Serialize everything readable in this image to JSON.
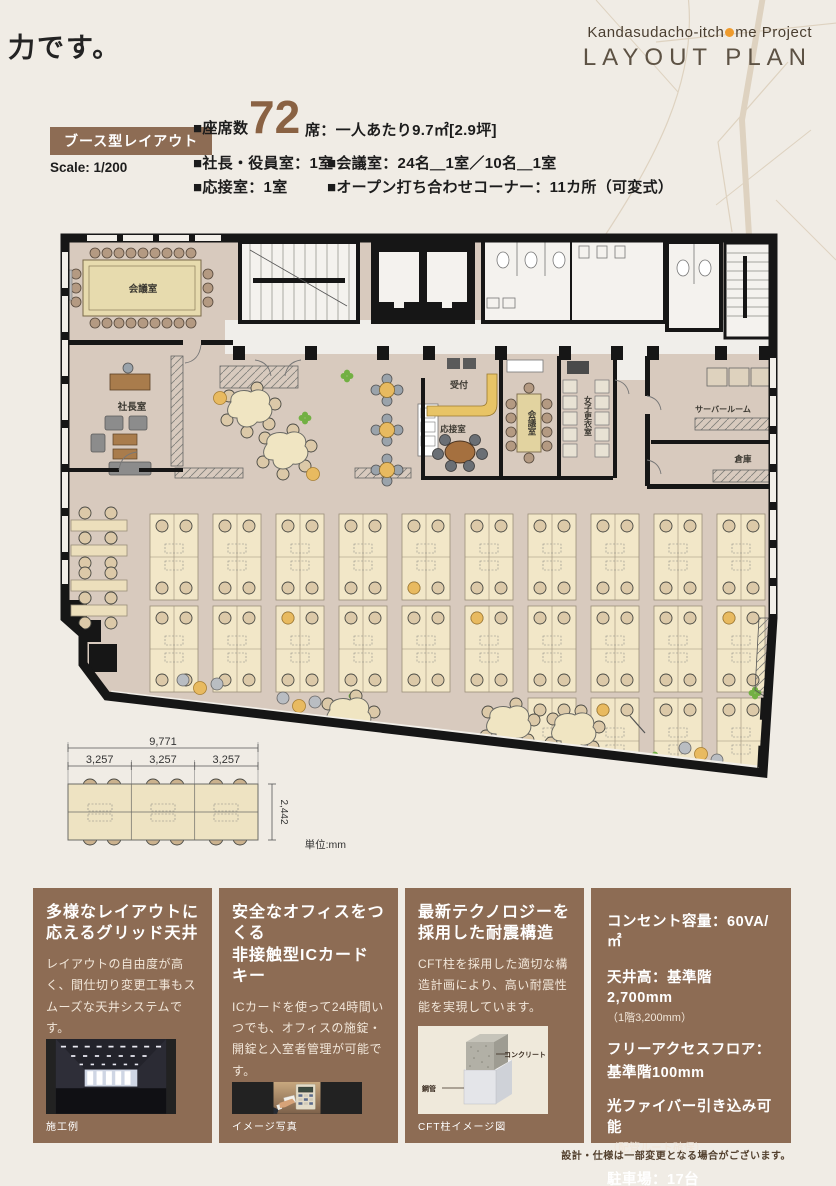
{
  "header": {
    "fragment": "力です。",
    "project_pre": "Kandasudacho-itch",
    "project_post": "me Project",
    "title": "LAYOUT PLAN"
  },
  "plan_info": {
    "type_label": "ブース型レイアウト",
    "scale": "Scale: 1/200",
    "seats": {
      "label": "■座席数",
      "value": "72",
      "detail": "席：一人あたり9.7㎡[2.9坪]"
    },
    "rooms": [
      {
        "label": "■社長・役員室：1室"
      },
      {
        "label": "■会議室：24名＿1室／10名＿1室"
      },
      {
        "label": "■応接室：1室"
      },
      {
        "label": "■オープン打ち合わせコーナー：11カ所（可変式）"
      }
    ]
  },
  "floor_plan": {
    "rooms": {
      "conference_large": "会議室",
      "president": "社長室",
      "reception_counter": "受付",
      "reception_room": "応接室",
      "conference_small": "会議室",
      "womens_locker": "女子更衣室",
      "server_room": "サーバールーム",
      "storage": "倉庫"
    },
    "dimensions": {
      "total_width": "9,771",
      "segment": "3,257",
      "depth": "2,442",
      "unit": "単位:mm"
    }
  },
  "features": [
    {
      "title_line1": "多様なレイアウトに",
      "title_line2": "応えるグリッド天井",
      "body": "レイアウトの自由度が高く、間仕切り変更工事もスムーズな天井システムです。",
      "caption": "施工例"
    },
    {
      "title_line1": "安全なオフィスをつくる",
      "title_line2": "非接触型ICカードキー",
      "body": "ICカードを使って24時間いつでも、オフィスの施錠・開錠と入室者管理が可能です。",
      "caption": "イメージ写真"
    },
    {
      "title_line1": "最新テクノロジーを",
      "title_line2": "採用した耐震構造",
      "body": "CFT柱を採用した適切な構造計画により、高い耐震性能を実現しています。",
      "caption": "CFT柱イメージ図",
      "diagram_labels": {
        "concrete": "コンクリート",
        "steel_tube": "鋼管"
      }
    }
  ],
  "building_specs": {
    "items": [
      {
        "line1": "コンセント容量：60VA/㎡",
        "line2": ""
      },
      {
        "line1": "天井高：基準階2,700mm",
        "line2": "（1階3,200mm）"
      },
      {
        "line1": "フリーアクセスフロア：",
        "line2": "基準階100mm"
      },
      {
        "line1": "光ファイバー引き込み可能",
        "line2": "（配管ルート確保）"
      },
      {
        "line1": "駐車場：17台",
        "line2": ""
      },
      {
        "line1": "エレベーター：2基",
        "line2": ""
      }
    ]
  },
  "footnote": "設計・仕様は一部変更となる場合がございます。",
  "colors": {
    "accent_orange": "#ef9b2d",
    "card_brown": "#8d6c54",
    "number_brown": "#8a6243",
    "plan_floor": "#d8cabe",
    "accent_yellow": "#e8ba60",
    "plant_green": "#72b043"
  }
}
